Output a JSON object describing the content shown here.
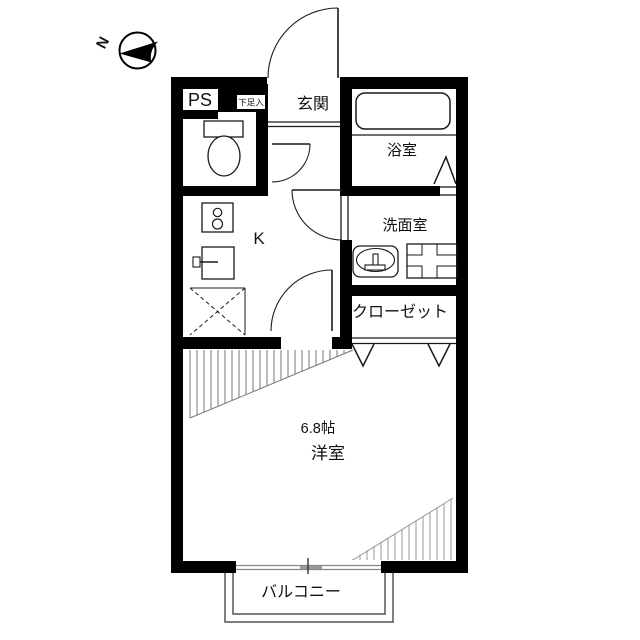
{
  "compass": {
    "north_label": "N"
  },
  "labels": {
    "ps": "PS",
    "shoe_storage": "下足入",
    "entrance": "玄関",
    "bathroom": "浴室",
    "washroom": "洗面室",
    "closet": "クローゼット",
    "kitchen": "K",
    "room_size": "6.8帖",
    "room": "洋室",
    "balcony": "バルコニー"
  },
  "colors": {
    "wall": "#000000",
    "line": "#1a1a1a",
    "hatch_primary": "#777777",
    "hatch_secondary": "#999999",
    "balcony_rail": "#555555",
    "window_line": "#888888"
  }
}
